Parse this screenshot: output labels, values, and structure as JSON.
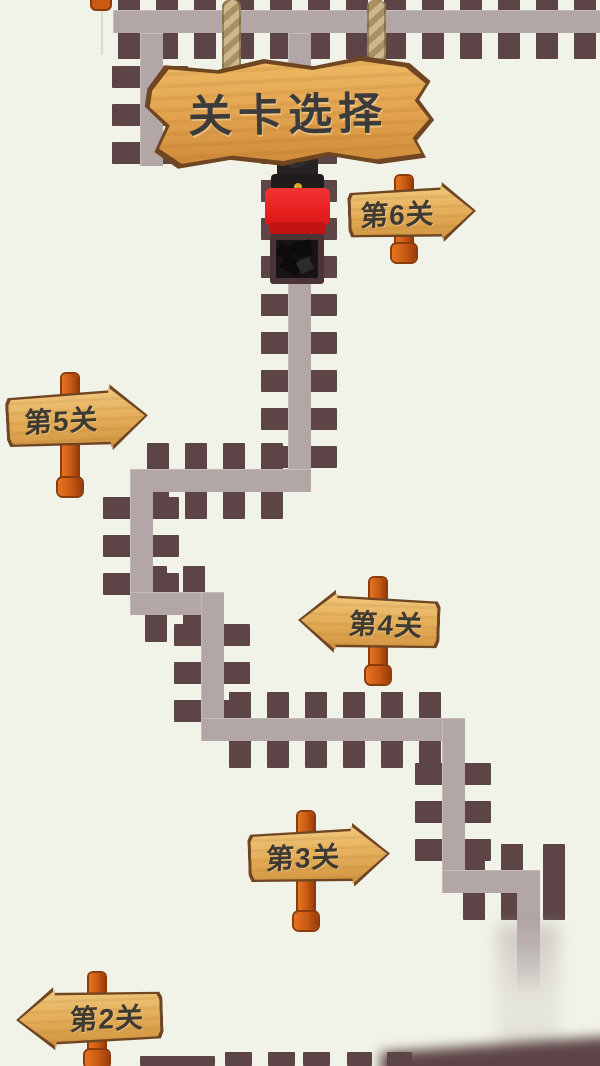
{
  "title_sign": {
    "label": "关卡选择"
  },
  "level_signs": [
    {
      "label": "第6关",
      "level": 6,
      "direction": "right"
    },
    {
      "label": "第5关",
      "level": 5,
      "direction": "right"
    },
    {
      "label": "第4关",
      "level": 4,
      "direction": "left"
    },
    {
      "label": "第3关",
      "level": 3,
      "direction": "right"
    },
    {
      "label": "第2关",
      "level": 2,
      "direction": "left"
    }
  ],
  "player": {
    "description": "coal mine cart marker at level 6 junction"
  },
  "colors": {
    "background": "#f1f2e8",
    "road": "#b2a7a6",
    "tie": "#5d4547",
    "sign_wood_light": "#f0c87c",
    "sign_wood_dark": "#d0933f",
    "sign_border": "#6f4522",
    "title_text": "#3b3b3b",
    "post": "#c85a14",
    "rope": "#cdb88e",
    "cart_red": "#e82020"
  }
}
